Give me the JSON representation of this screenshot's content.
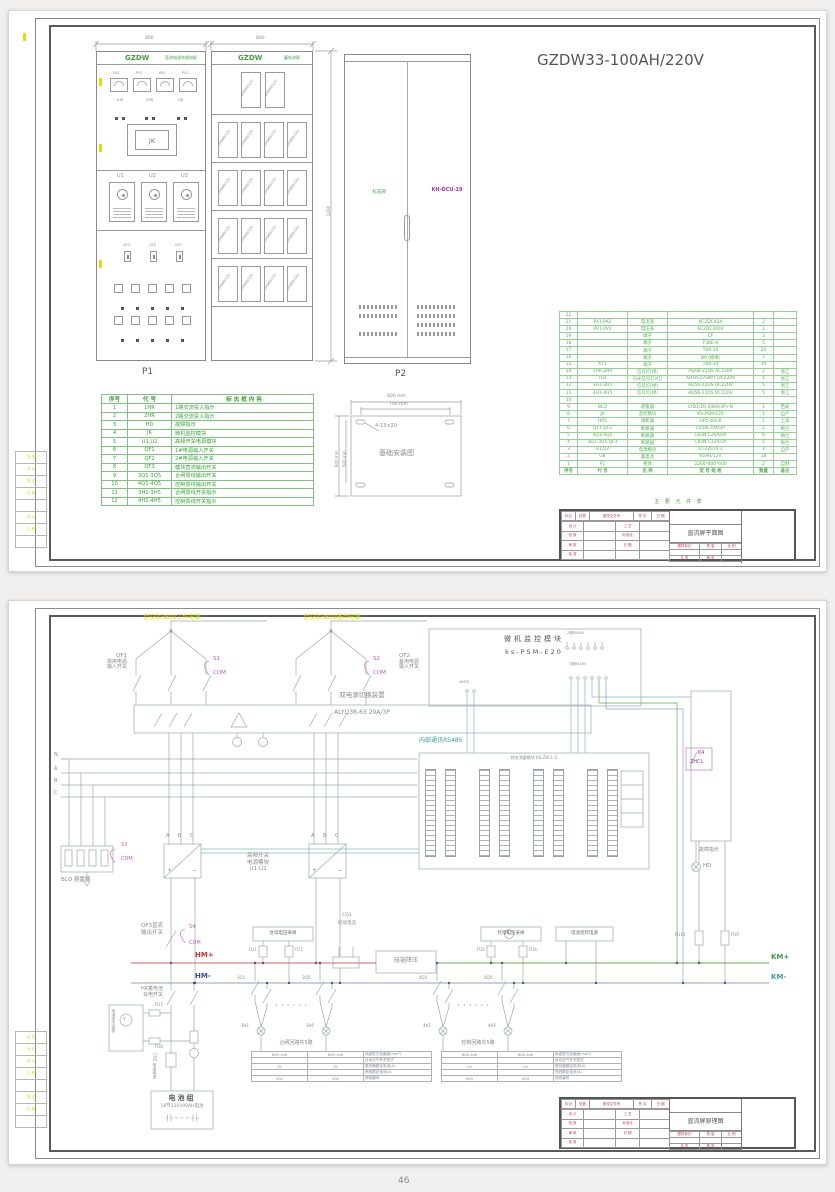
{
  "page_no": "46",
  "tb": {
    "rev": [
      [
        "标记",
        "处数",
        "更改文件号",
        "签 字",
        "日 期"
      ]
    ],
    "grid": [
      [
        "设 计",
        "",
        "工 艺",
        ""
      ],
      [
        "校 核",
        "",
        "标准化",
        ""
      ],
      [
        "审 核",
        "",
        "日 期",
        ""
      ],
      [
        "批 准",
        "",
        "",
        ""
      ]
    ],
    "mark": [
      [
        "图样标记",
        "质 量",
        "比 例"
      ],
      [
        "",
        "",
        ""
      ],
      [
        "共  张",
        "第  张",
        ""
      ]
    ]
  },
  "margin_rows": [
    [
      "会 签"
    ],
    [
      "专 业"
    ],
    [
      "签 字"
    ],
    [
      "日 期"
    ],
    [
      ""
    ],
    [
      "签 字"
    ],
    [
      "日 期"
    ],
    [
      ""
    ]
  ],
  "sheet1": {
    "big_title": "GZDW33-100AH/220V",
    "p1_label": "P1",
    "p2_label": "P2",
    "dim_cab1": "800",
    "dim_cab2": "800",
    "dim_height": "2260",
    "tb_title": "直流屏平面图",
    "cabinet1": {
      "brand": "GZDW",
      "name": "直流电源充馈电屏",
      "jk": "JK",
      "meters": [
        "PA1",
        "PV1",
        "PA2",
        "PV2"
      ],
      "lamps": [
        "1HR",
        "2HR",
        "HD"
      ],
      "modules": [
        "U1",
        "U2",
        "U3"
      ],
      "switches": [
        "QF3",
        "QF2",
        "QF1"
      ]
    },
    "cabinet2": {
      "brand": "GZDW",
      "name": "蓄电池屏",
      "cell": "100AH/12V"
    },
    "cabinet3": {
      "plate": "标志牌",
      "dcu": "KH-DCU-19"
    },
    "foundation": {
      "title": "基础安装图",
      "dw1": "800 mm",
      "dw2": "700 mm",
      "dh1": "600 mm",
      "dh2": "500 mm",
      "slots": "4-13×20"
    },
    "legend_rows": [
      [
        "序号",
        "代  号",
        "标 志 框 内 容"
      ],
      [
        "1",
        "1HR",
        "1路交流投入指示"
      ],
      [
        "2",
        "2HR",
        "2路交流投入指示"
      ],
      [
        "3",
        "HD",
        "故障指示"
      ],
      [
        "4",
        "JK",
        "微机监控模块"
      ],
      [
        "5",
        "U1,U2",
        "高频开关电源模块"
      ],
      [
        "6",
        "QF1",
        "1#电源输入开关"
      ],
      [
        "7",
        "QF2",
        "2#电源输入开关"
      ],
      [
        "8",
        "QF3",
        "模块直流输出开关"
      ],
      [
        "9",
        "3Q1-3Q5",
        "合闸馈线输出开关"
      ],
      [
        "10",
        "4Q1-4Q5",
        "控制馈线输出开关"
      ],
      [
        "11",
        "3H1-3H5",
        "合闸馈线开关指示"
      ],
      [
        "12",
        "4H1-4H5",
        "控制馈线开关指示"
      ]
    ],
    "bom_caption": "主 要 元 件 表",
    "bom_rows": [
      [
        "22",
        "",
        "",
        "",
        "",
        ""
      ],
      [
        "21",
        "PA1,PA2",
        "电流表",
        "6C2DC40A",
        "2",
        ""
      ],
      [
        "20",
        "PV1,PV2",
        "电压表",
        "6C2DC300V",
        "2",
        ""
      ],
      [
        "19",
        "",
        "端子",
        "CF",
        "3",
        ""
      ],
      [
        "18",
        "",
        "端子",
        "F36E-6",
        "5",
        ""
      ],
      [
        "17",
        "",
        "端子",
        "TBR-10",
        "24",
        ""
      ],
      [
        "16",
        "",
        "端子",
        "Φ9 (绝缘)",
        "2",
        ""
      ],
      [
        "15",
        "XT1",
        "端子",
        "TBR-30",
        "30",
        ""
      ],
      [
        "14",
        "1HR,2HR",
        "信号灯(绿)",
        "AD56-22DS AC220V",
        "2",
        "浙江"
      ],
      [
        "13",
        "HD",
        "闪光信号灯(红)",
        "AD56-22SM/Y DC220V",
        "1",
        "浙江"
      ],
      [
        "12",
        "3H1-3H5",
        "信号灯(绿)",
        "AD56-22DS DC220V",
        "5",
        "浙江"
      ],
      [
        "11",
        "4H1-4H5",
        "信号灯(绿)",
        "AD56-22DS DC220V",
        "5",
        "浙江"
      ],
      [
        "10",
        "",
        "",
        "",
        "",
        ""
      ],
      [
        "9",
        "BLQ",
        "避雷器",
        "LYD1/20-40KA/3P+N",
        "1",
        "西安"
      ],
      [
        "8",
        "JK",
        "监控模块",
        "KS-PSM-E20",
        "1",
        "自产"
      ],
      [
        "7",
        "HR5",
        "熔断器",
        "HR5-60/3I",
        "1",
        "上海"
      ],
      [
        "6",
        "QF1,QF2",
        "断路器",
        "C65N 20A/3P",
        "2",
        "梅兰"
      ],
      [
        "5",
        "4Q1-4Q5",
        "断路器",
        "C65N C20A/2P",
        "6",
        "梅兰"
      ],
      [
        "4",
        "3Q1-3Q5,QF3",
        "断路器",
        "C65N C32A/2P",
        "5",
        "梅兰"
      ],
      [
        "3",
        "U1,U2",
        "电源模块",
        "UT22010-2",
        "2",
        "自产"
      ],
      [
        "2",
        "GB",
        "蓄电池",
        "65AH/12V",
        "18",
        ""
      ],
      [
        "1",
        "P1",
        "柜体",
        "2260*800*600",
        "2",
        "自制"
      ],
      [
        "序号",
        "代 号",
        "名 称",
        "型 号 规 格",
        "数量",
        "备注"
      ]
    ]
  },
  "sheet2": {
    "tb_title": "直流屏原理图",
    "supply_left": "至交流380V工作电源",
    "supply_right": "至交流380V备用电源",
    "qf1": {
      "code": "QF1",
      "line1": "常用电源",
      "line2": "输入开关",
      "aux": "S1",
      "com": "COM"
    },
    "qf2": {
      "code": "QF2",
      "line1": "备用电源",
      "line2": "输入开关",
      "aux": "S2",
      "com": "COM"
    },
    "ats": {
      "title": "双电源切换装置",
      "model": "ALYQ3R-63 20A/3P"
    },
    "monitor": {
      "line1": "微机监控模块",
      "line2": "ks-PSM-E20",
      "grp1": "2路RS485",
      "grp2": "3路RS485",
      "grp3": "485口"
    },
    "rs485": "内部通讯RS485",
    "phases": [
      "N",
      "A",
      "B",
      "C"
    ],
    "blq": {
      "label": "BLQ 避雷器",
      "aux": "S3",
      "com": "COM"
    },
    "rect": {
      "a": "A",
      "b": "B",
      "c": "C",
      "plus": "+",
      "minus": "−",
      "line1": "高频开关",
      "line2": "电源模块",
      "line3": "U1-U2"
    },
    "zhcl_title": "综合测量模块 KS-ZHCL-2",
    "k4": {
      "code": "K4",
      "name": "ZHCL"
    },
    "fault": {
      "label": "故障指示",
      "code": "HD"
    },
    "qf3": {
      "line1": "QF3直流",
      "line2": "输出开关",
      "aux": "S4",
      "com": "COM"
    },
    "bus": {
      "hmp": "HM+",
      "hmm": "HM-",
      "kmp": "KM+",
      "kmm": "KM-"
    },
    "hm_sample": {
      "label": "合母电压采样",
      "fu1": "FU1",
      "fu2": "FU2"
    },
    "cq1": {
      "code": "CQ1",
      "label": "控母电流"
    },
    "silicon": "硅链降压",
    "km_sample": {
      "label": "控母电压采样",
      "fu5": "FU5",
      "fu6": "FU6",
      "v": "V"
    },
    "patrol": "电池巡检电源",
    "fu9": "FU9",
    "fu10": "FU10",
    "hk": {
      "line1": "HK蓄电池",
      "line2": "充电开关"
    },
    "bat_sample": "电池电压采样",
    "bat_v": "V",
    "fu7": "FU7",
    "fu8": "FU8",
    "cq2": "CQ2 电池电流",
    "battery": {
      "title": "电池组",
      "subtitle": "18节12V100AH电池",
      "symbols": "┤├ ╌ ╌ ╌ ┤├"
    },
    "feeder_close": {
      "title": "合闸回路共5路",
      "q1": "3Q1",
      "q5": "3Q5",
      "h1": "3H1",
      "h5": "3H5",
      "rows": [
        [
          "BVV-2x6",
          "BVV-2x6",
          "电缆型式及截面(mm²)"
        ],
        [
          "",
          "",
          "自动空气开关型式"
        ],
        [
          "32",
          "32",
          "脱扣器额定电流(A)"
        ],
        [
          "",
          "",
          "馈线额定电流(A)"
        ],
        [
          "3Q1",
          "3Q5",
          "馈线编号"
        ]
      ]
    },
    "feeder_ctrl": {
      "title": "控制回路共5路",
      "q1": "4Q1",
      "q5": "4Q5",
      "h1": "4H1",
      "h5": "4H5",
      "rows": [
        [
          "BVV-2x6",
          "BVV-2x6",
          "电缆型式及截面(mm²)"
        ],
        [
          "",
          "",
          "自动空气开关型式"
        ],
        [
          "20",
          "20",
          "脱扣器额定电流(A)"
        ],
        [
          "",
          "",
          "馈线额定电流(A)"
        ],
        [
          "4Q1",
          "4Q5",
          "馈线编号"
        ]
      ]
    }
  }
}
